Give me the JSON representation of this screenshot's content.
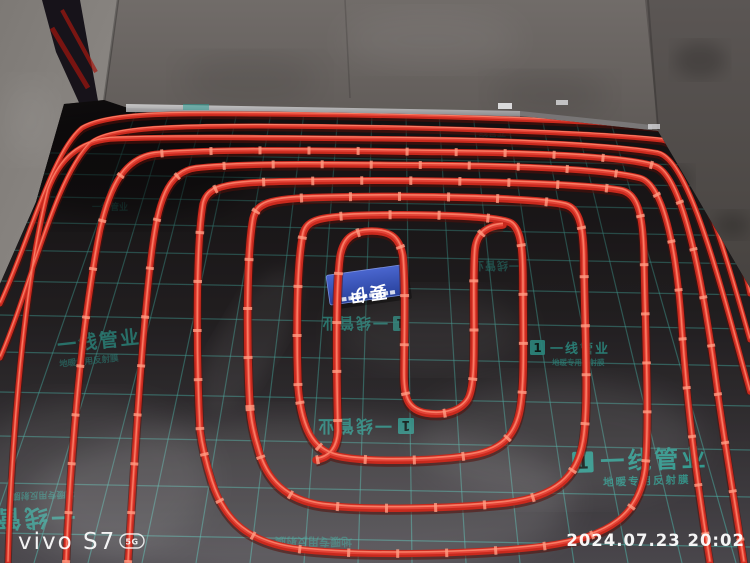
{
  "watermark": {
    "device": "vivo S7",
    "badge": "5G",
    "timestamp": "2024.07.23 20:02"
  },
  "film": {
    "brand": "一线管业",
    "tagline": "地暖专用反射膜",
    "logo_glyph": "1"
  },
  "center_label": {
    "text": "要伊"
  },
  "colors": {
    "pipe_red": "#c8291d",
    "grid_teal": "#3aa99e",
    "label_blue": "#3752b8",
    "wall_gray": "#6e6a67"
  }
}
